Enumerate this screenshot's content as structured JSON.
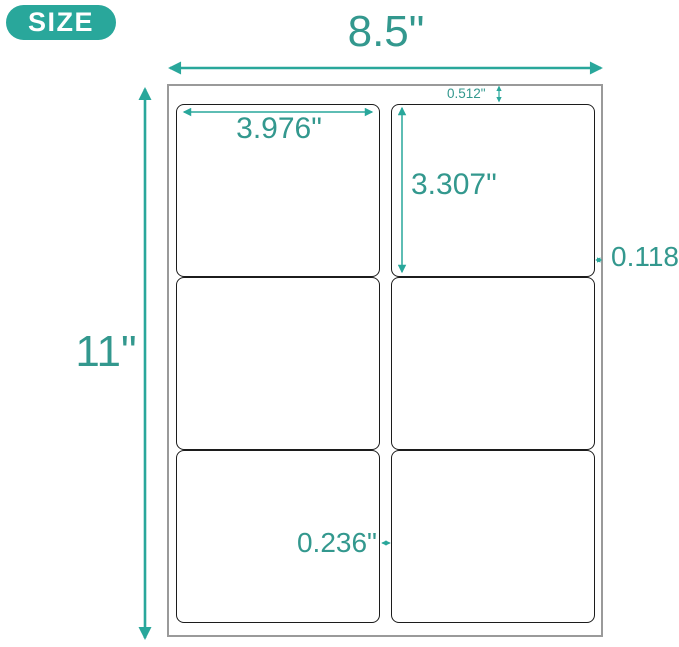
{
  "badge": {
    "label": "SIZE"
  },
  "colors": {
    "accent": "#29A79B",
    "dim_text": "#33988E",
    "sheet_border": "#9A9A9A",
    "label_border": "#1C1C1C",
    "badge_text": "#FFFFFF",
    "bg": "#FFFFFF"
  },
  "sheet": {
    "rows": 3,
    "columns": 2,
    "labels_per_sheet": 6
  },
  "measurements": {
    "sheet_width": "8.5\"",
    "sheet_height": "11\"",
    "label_width": "3.976\"",
    "label_height": "3.307\"",
    "top_margin": "0.512\"",
    "side_margin": "0.118\"",
    "column_gap": "0.236\""
  }
}
